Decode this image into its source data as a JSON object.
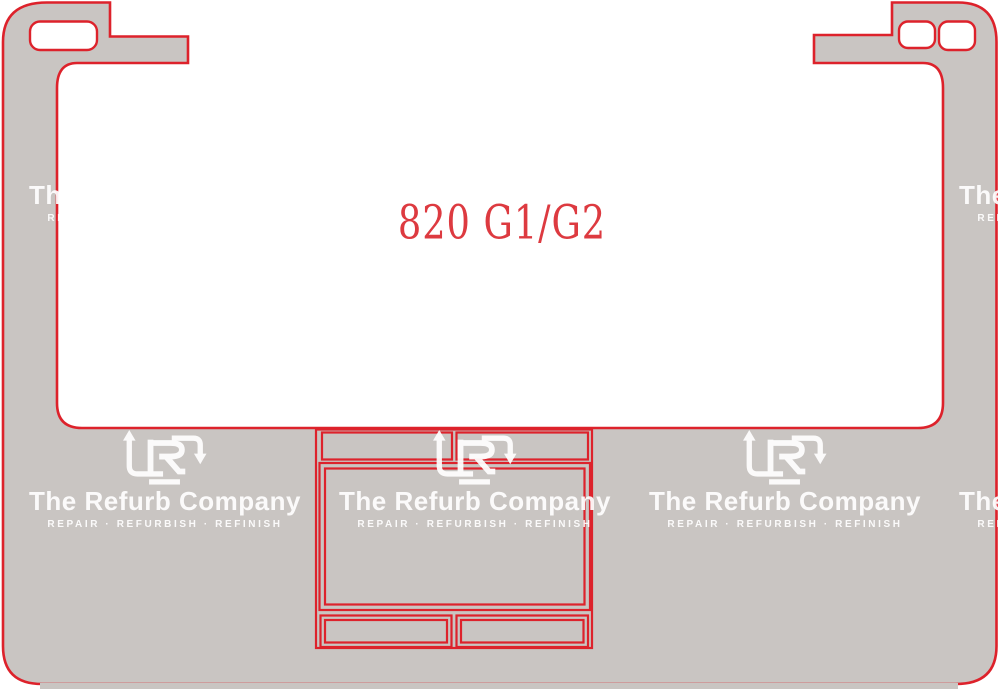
{
  "template": {
    "model_label": "820 G1/G2",
    "description_of_drawing": "laptop palmrest skin cutting template outline",
    "parts": {
      "left_hinge_cutout": "rounded-rect cutout in top-left tab",
      "right_hinge_cutouts": "two rounded-rect cutouts in top-right tab",
      "keyboard_cutout": "large open notch in center",
      "touchpad": "double-outlined rectangle below keyboard",
      "touchpad_button_rows": "two-cell strip above and below touchpad"
    }
  },
  "watermark": {
    "title": "The Refurb Company",
    "tagline": "REPAIR · REFURBISH · REFINISH",
    "logo": "refurb-arrows-r-logo"
  },
  "colors": {
    "outline_red": "#dd222b",
    "body_gray": "#c9c5c2",
    "cutout_white": "#ffffff",
    "label_red": "#dd3a40",
    "watermark_white": "#ffffff"
  }
}
